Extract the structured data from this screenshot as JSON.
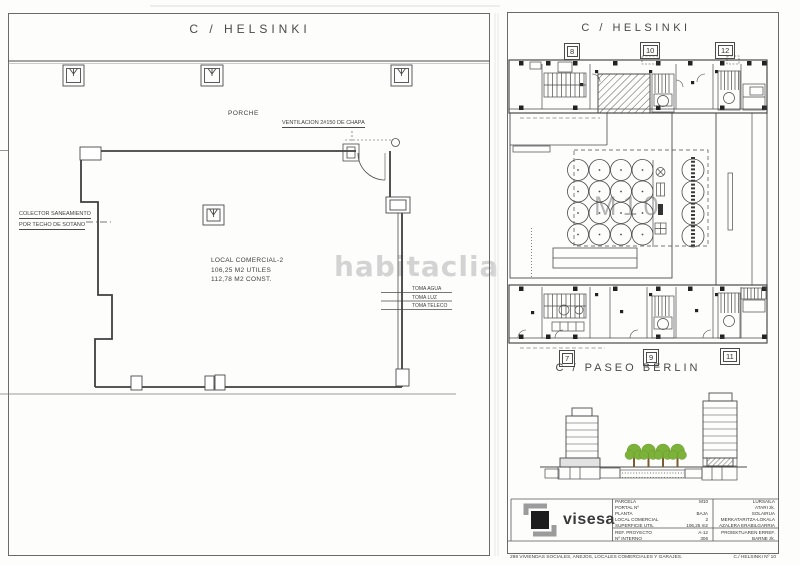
{
  "left_plan": {
    "street_label": "C / HELSINKI",
    "porch_label": "PORCHE",
    "ventilation_label": "VENTILACION 2#150 DE CHAPA",
    "collector_line1": "COLECTOR SANEAMIENTO",
    "collector_line2": "POR TECHO DE SOTANO",
    "unit_name": "LOCAL COMERCIAL-2",
    "area_useful": "106,25 M2 UTILES",
    "area_built": "112,78 M2 CONST.",
    "utility_labels": [
      "TOMA AGUA",
      "TOMA LUZ",
      "TOMA TELECO"
    ],
    "watermark": "habitaclia"
  },
  "site_plan": {
    "street_top": "C / HELSINKI",
    "street_bottom": "C / PASEO BERLIN",
    "portal_numbers_top": [
      "8",
      "10",
      "12"
    ],
    "portal_numbers_bottom": [
      "7",
      "9",
      "11"
    ],
    "block_label": "M10"
  },
  "title_block": {
    "logo_text": "visesa",
    "rows": [
      {
        "label": "PARCELA",
        "value": "M10",
        "label_eu": "LURSAILA"
      },
      {
        "label": "PORTAL Nº",
        "value": "",
        "label_eu": "ATARI zk."
      },
      {
        "label": "PLANTA",
        "value": "BAJA",
        "label_eu": "SOLAIRUA"
      },
      {
        "label": "LOCAL COMERCIAL",
        "value": "2",
        "label_eu": "MERKATARITZA-LOKALA"
      },
      {
        "label": "SUPERFICIE UTIL",
        "value": "106,25 m2",
        "label_eu": "AZALERA ERABILGARRIA"
      },
      {
        "label": "REF. PROYECTO",
        "value": "A-12",
        "label_eu": "PROIEKTUAREN ERREF."
      },
      {
        "label": "Nº INTERNO",
        "value": "306",
        "label_eu": "BARNE zk."
      }
    ],
    "project_line1": "298 VIVIENDAS SOCIALES, ANEJOS, LOCALES COMERCIALES Y GARAJES.",
    "project_line2": "298 ETXEBIZITZA SOZIAL, ERANSKIN, LOKAL ETA GARAJEAK.",
    "address_line1": "C./ HELSINKI Nº 10",
    "address_line2": "SALBURUA.   VITORIA-GASTEIZ"
  },
  "colors": {
    "line": "#4a4a4a",
    "tree_green": "#7db23a",
    "watermark_gray": "#cfcfcf"
  }
}
